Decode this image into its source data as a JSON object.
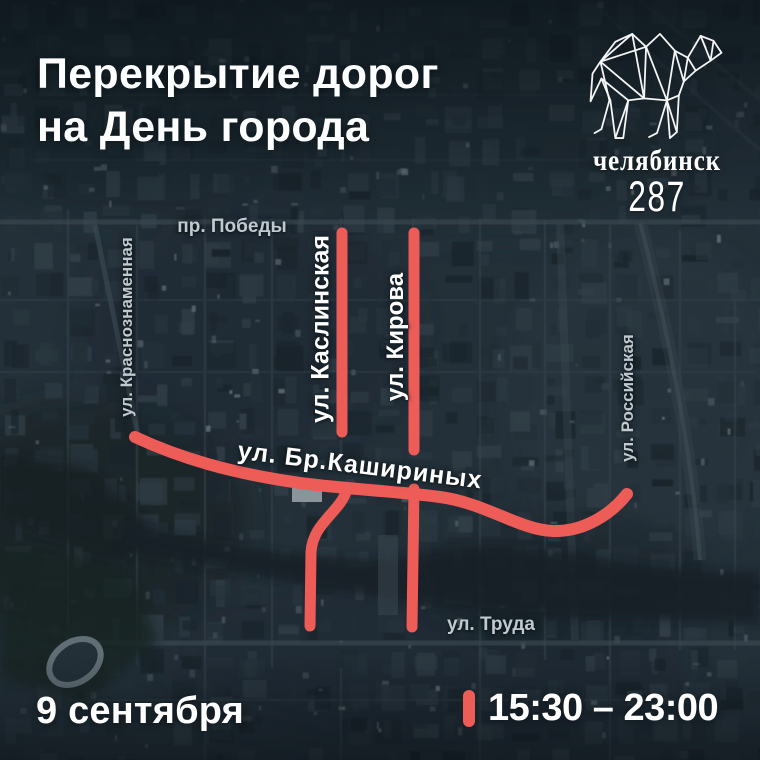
{
  "header": {
    "title_line1": "Перекрытие дорог",
    "title_line2": "на День города"
  },
  "logo": {
    "icon": "camel-lowpoly-icon",
    "city": "челябинск",
    "anniversary_number": "287"
  },
  "map": {
    "closure_color": "#ee5c58",
    "streets": {
      "pobedy": "пр. Победы",
      "krasnoznamennaya": "ул. Краснознаменная",
      "kaslinskaya": "ул. Каслинская",
      "kirova": "ул. Кирова",
      "bratev_kashirinykh": "ул. Бр.Кашириных",
      "rossiyskaya": "ул. Российская",
      "truda": "ул. Труда"
    }
  },
  "footer": {
    "date": "9 сентября",
    "time_range": "15:30 – 23:00"
  }
}
